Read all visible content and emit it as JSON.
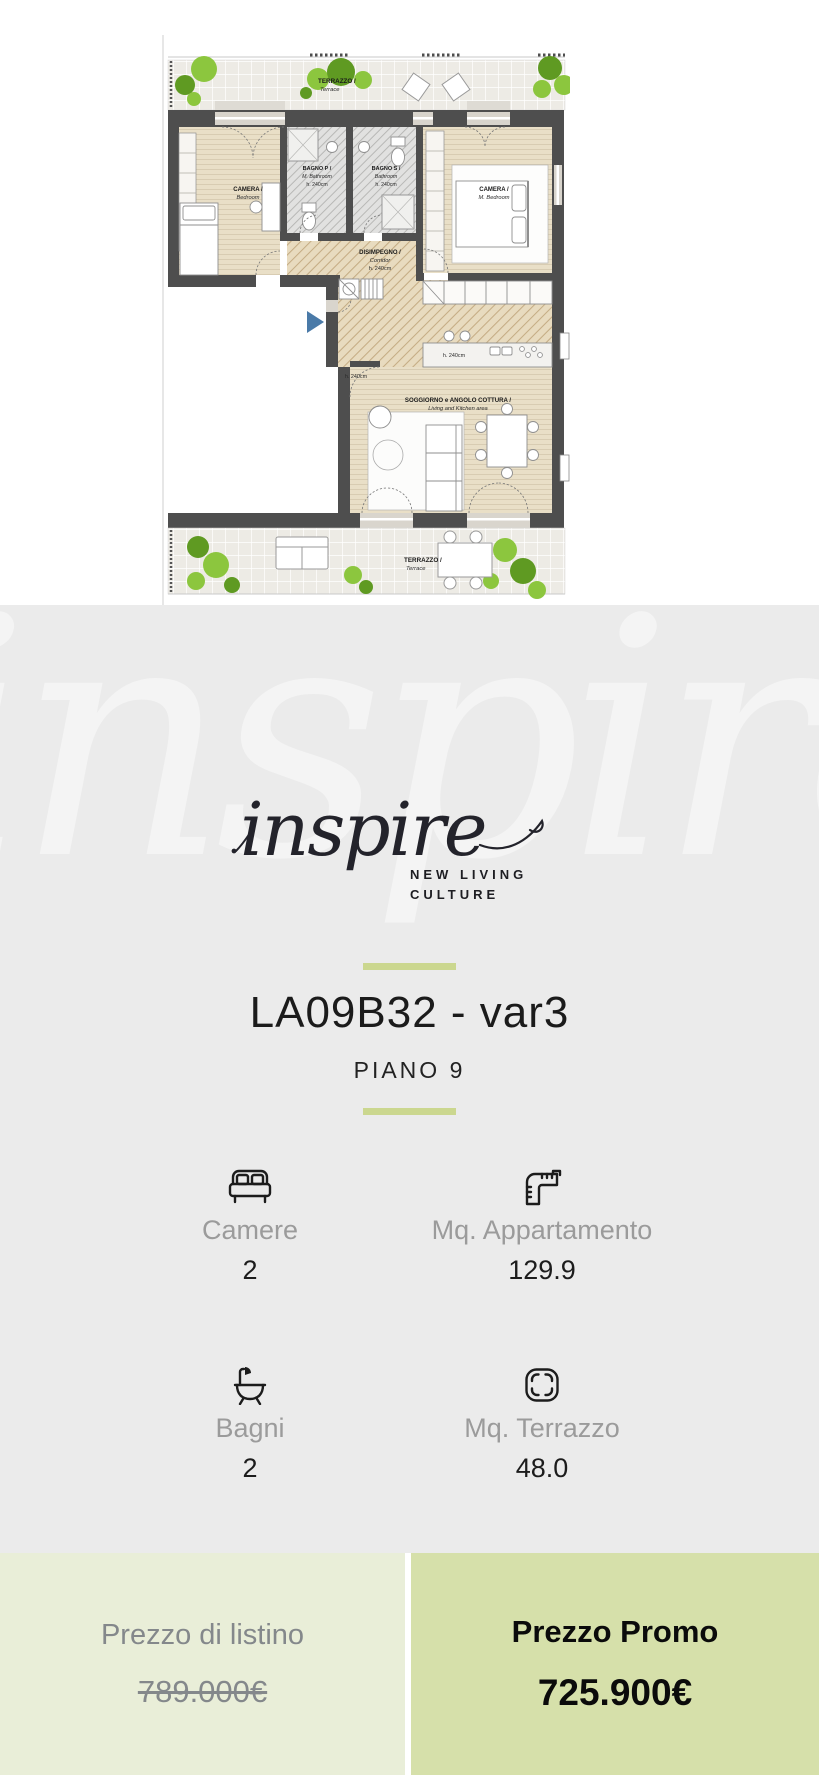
{
  "plan": {
    "labels": {
      "terrace_top_1": "TERRAZZO /",
      "terrace_top_2": "Terrace",
      "camera_left_1": "CAMERA /",
      "camera_left_2": "Bedroom",
      "bagno_p_1": "BAGNO P /",
      "bagno_p_2": "M. Bathroom",
      "bagno_p_3": "h. 240cm",
      "bagno_s_1": "BAGNO S /",
      "bagno_s_2": "Bathroom",
      "bagno_s_3": "h. 240cm",
      "camera_master_1": "CAMERA /",
      "camera_master_2": "M. Bedroom",
      "corridor_1": "DISIMPEGNO /",
      "corridor_2": "Corridor",
      "corridor_3": "h. 240cm",
      "kitchen_h": "h. 240cm",
      "living_h": "h. 240cm",
      "living_1": "SOGGIORNO e ANGOLO COTTURA /",
      "living_2": "Living and Kitchen area",
      "terrace_bottom_1": "TERRAZZO /",
      "terrace_bottom_2": "Terrace"
    }
  },
  "brand": {
    "watermark": "inspire",
    "logo_text": "inspire",
    "tagline_line1": "NEW LIVING",
    "tagline_line2": "CULTURE"
  },
  "listing": {
    "title": "LA09B32 - var3",
    "floor": "PIANO 9"
  },
  "stats": [
    {
      "icon": "bed-icon",
      "label": "Camere",
      "value": "2"
    },
    {
      "icon": "ruler-icon",
      "label": "Mq. Appartamento",
      "value": "129.9"
    },
    {
      "icon": "bathtub-icon",
      "label": "Bagni",
      "value": "2"
    },
    {
      "icon": "area-icon",
      "label": "Mq. Terrazzo",
      "value": "48.0"
    }
  ],
  "pricing": {
    "list_label": "Prezzo di listino",
    "list_value": "789.000€",
    "promo_label": "Prezzo Promo",
    "promo_value": "725.900€"
  },
  "colors": {
    "section_bg": "#ebebeb",
    "divider_green": "#cbd78f",
    "price_list_bg": "#e9eed8",
    "price_promo_bg": "#d6e0aa",
    "wall": "#4e4e4e",
    "tree_green_light": "#8cc63e",
    "tree_green_dark": "#5f9a22",
    "entrance_arrow_blue": "#4a7aa8",
    "muted_text": "#9b9b9b"
  }
}
